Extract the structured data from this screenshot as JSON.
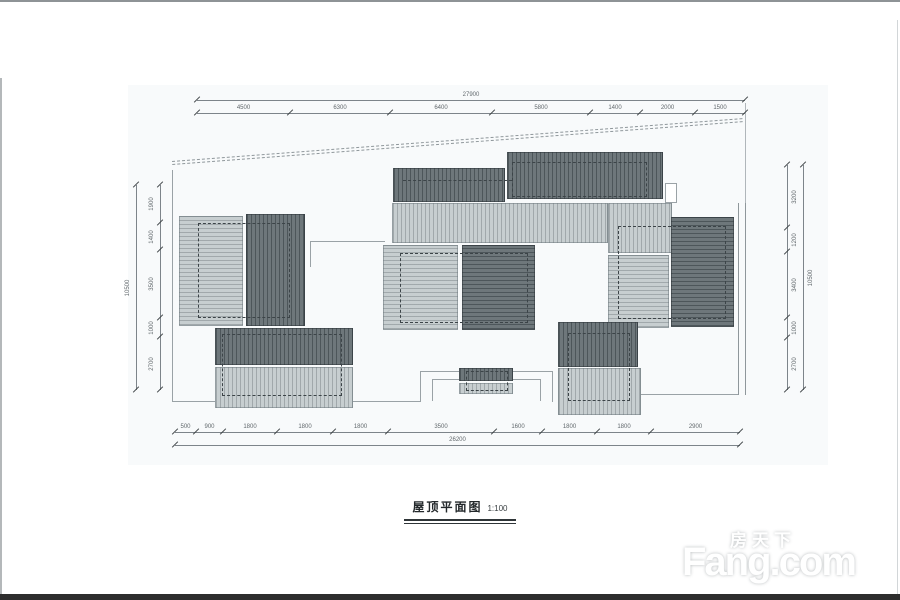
{
  "title": {
    "text": "屋顶平面图",
    "scale": "1:100"
  },
  "watermark": {
    "cn": "房天下",
    "en": "Fang.com"
  },
  "dimensions": {
    "top": {
      "overall": "27900",
      "segments": [
        "4500",
        "6300",
        "6400",
        "5800",
        "1400",
        "2000",
        "1500"
      ]
    },
    "bottom": {
      "overall": "26200",
      "segments": [
        "500",
        "900",
        "1800",
        "1800",
        "1800",
        "3500",
        "1600",
        "1800",
        "1800",
        "2900"
      ]
    },
    "left": {
      "overall": "10500",
      "segments": [
        "1900",
        "1400",
        "3500",
        "1000",
        "2700"
      ]
    },
    "right": {
      "overall": "10500",
      "segments": [
        "3200",
        "1200",
        "3400",
        "1000",
        "2700"
      ]
    }
  },
  "colors": {
    "roof_dark": "#6e777b",
    "roof_light": "#c7ced0",
    "drawing_line": "#8f979b",
    "dim_text": "#61686c",
    "bottom_bar": "#2d2d2d"
  }
}
